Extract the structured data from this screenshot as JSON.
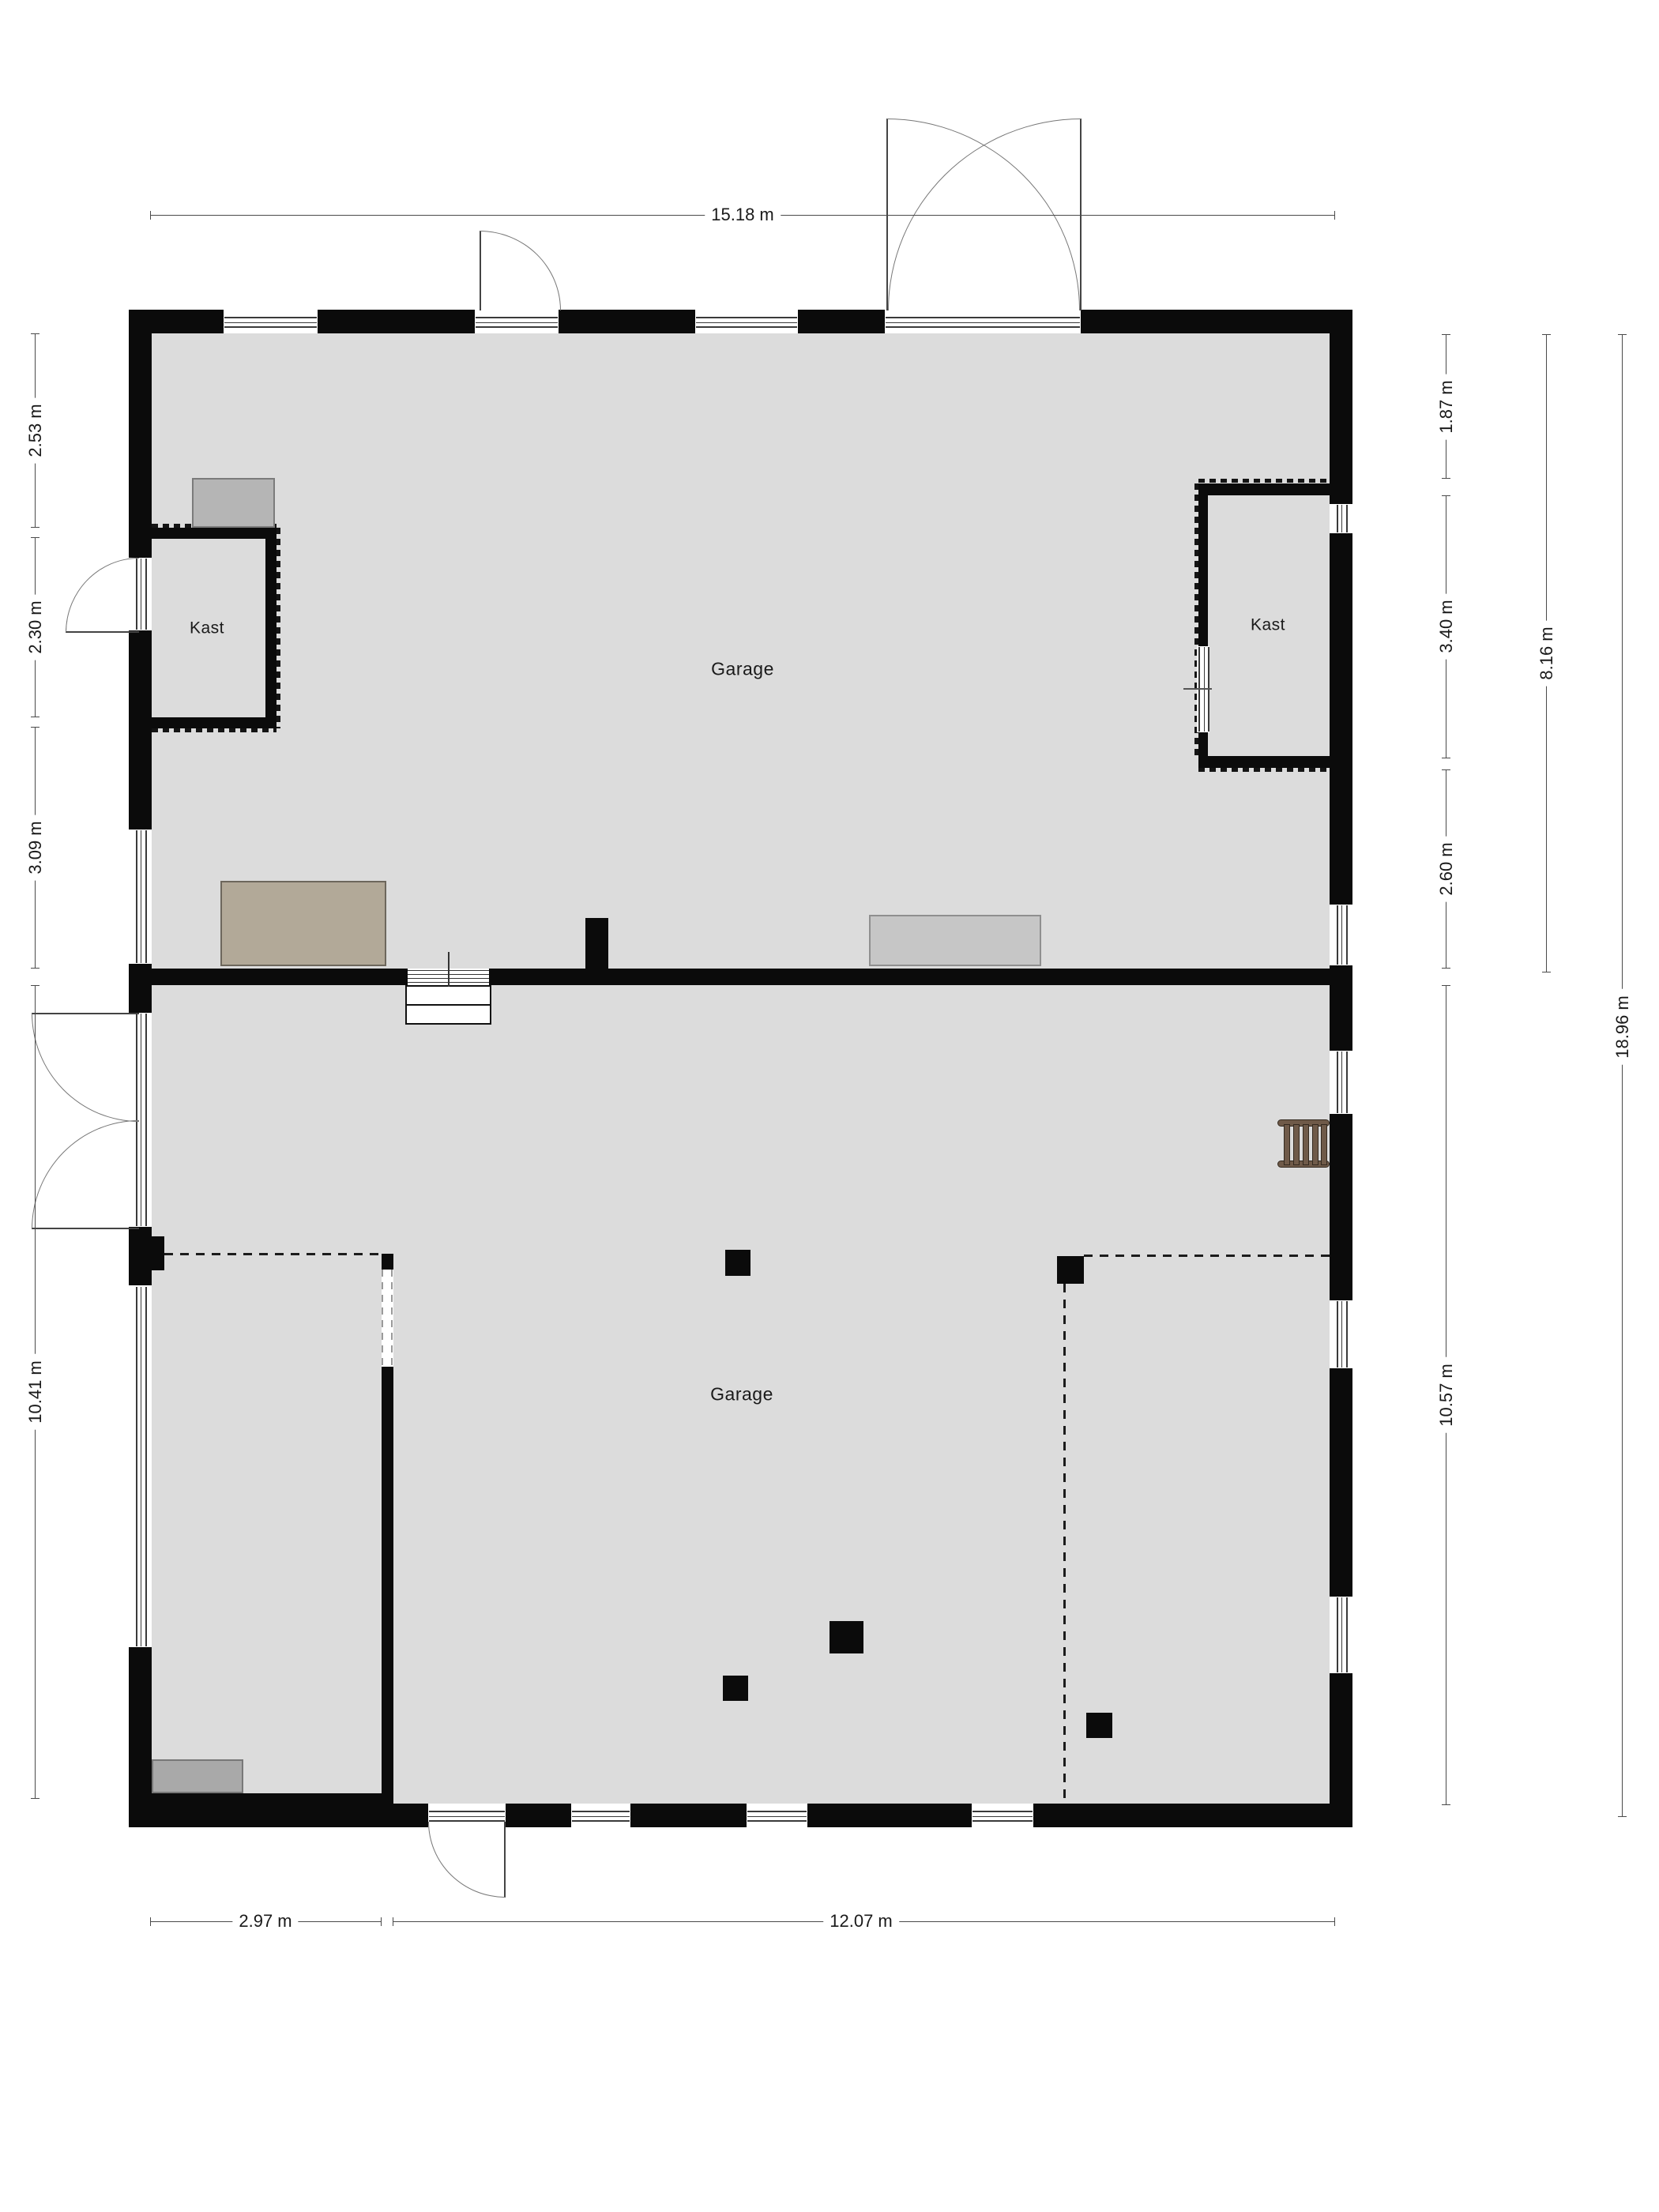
{
  "rooms": {
    "garage_upper": "Garage",
    "garage_lower": "Garage",
    "kast_left": "Kast",
    "kast_right": "Kast"
  },
  "dimensions": {
    "top": [
      {
        "label": "15.18 m"
      }
    ],
    "bottom": [
      {
        "label": "2.97 m"
      },
      {
        "label": "12.07 m"
      }
    ],
    "left": [
      {
        "label": "2.53 m"
      },
      {
        "label": "2.30 m"
      },
      {
        "label": "3.09 m"
      },
      {
        "label": "10.41 m"
      }
    ],
    "right_inner": [
      {
        "label": "1.87 m"
      },
      {
        "label": "3.40 m"
      },
      {
        "label": "2.60 m"
      },
      {
        "label": "10.57 m"
      }
    ],
    "right_middle": [
      {
        "label": "8.16 m"
      }
    ],
    "right_outer": [
      {
        "label": "18.96 m"
      }
    ]
  },
  "colors": {
    "wall": "#0b0b0b",
    "floor": "#dcdcdc",
    "line": "#4a4a4a",
    "arc": "#777777",
    "leaf": "#444444",
    "bench_gray": "#b5b5b5",
    "bench_tan": "#b2a998",
    "bench_light": "#c6c6c6",
    "bench_dark": "#a9a9a9",
    "ladder": "#6f5a49",
    "ladder_edge": "#33291f"
  }
}
